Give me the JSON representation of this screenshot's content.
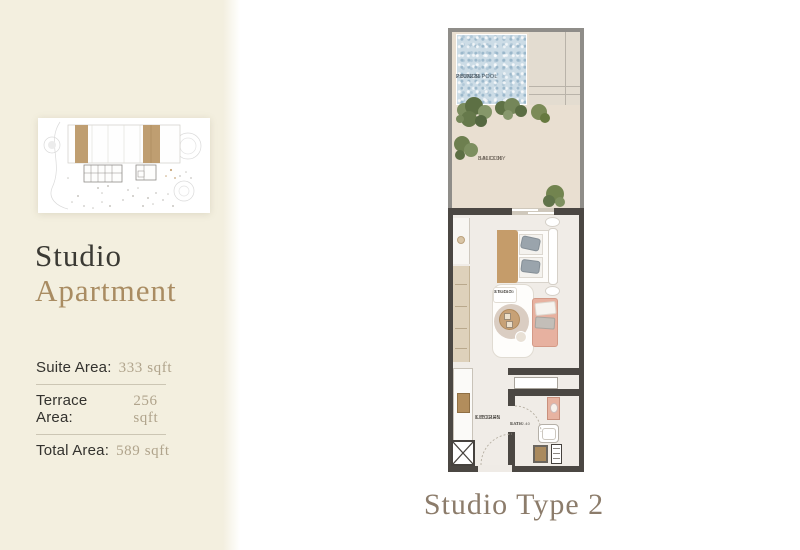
{
  "sidebar": {
    "title_line1": "Studio",
    "title_line2": "Apartment",
    "areas": [
      {
        "label": "Suite Area:",
        "value": "333 sqft"
      },
      {
        "label": "Terrace Area:",
        "value": "256 sqft"
      },
      {
        "label": "Total Area:",
        "value": "589 sqft"
      }
    ]
  },
  "plan": {
    "caption": "Studio Type 2",
    "rooms": {
      "pool": {
        "name": "PLUNGE POOL",
        "dims": "2.80X2.55"
      },
      "balcony": {
        "name": "BALCONY",
        "dims": "3.80X3.35"
      },
      "studio": {
        "name": "STUDIO",
        "dims": "3.50X5.20"
      },
      "kitchen": {
        "name": "KITCHEN",
        "dims": "1.85X2.45"
      },
      "bath": {
        "name": "BATH",
        "dims": "1.33X2.40"
      }
    }
  },
  "colors": {
    "sidebar_bg": "#f3efdf",
    "title_text": "#3b3a34",
    "accent_tan": "#a98c62",
    "value_text": "#b0a48c",
    "caption_text": "#8c7c6b",
    "pool_blue": "#ccdce6",
    "balcony_floor": "#e9dfd1",
    "wall_dark": "#4b4743",
    "wall_gray": "#8f8d89",
    "keyplan_highlight": "#bf9e71"
  }
}
